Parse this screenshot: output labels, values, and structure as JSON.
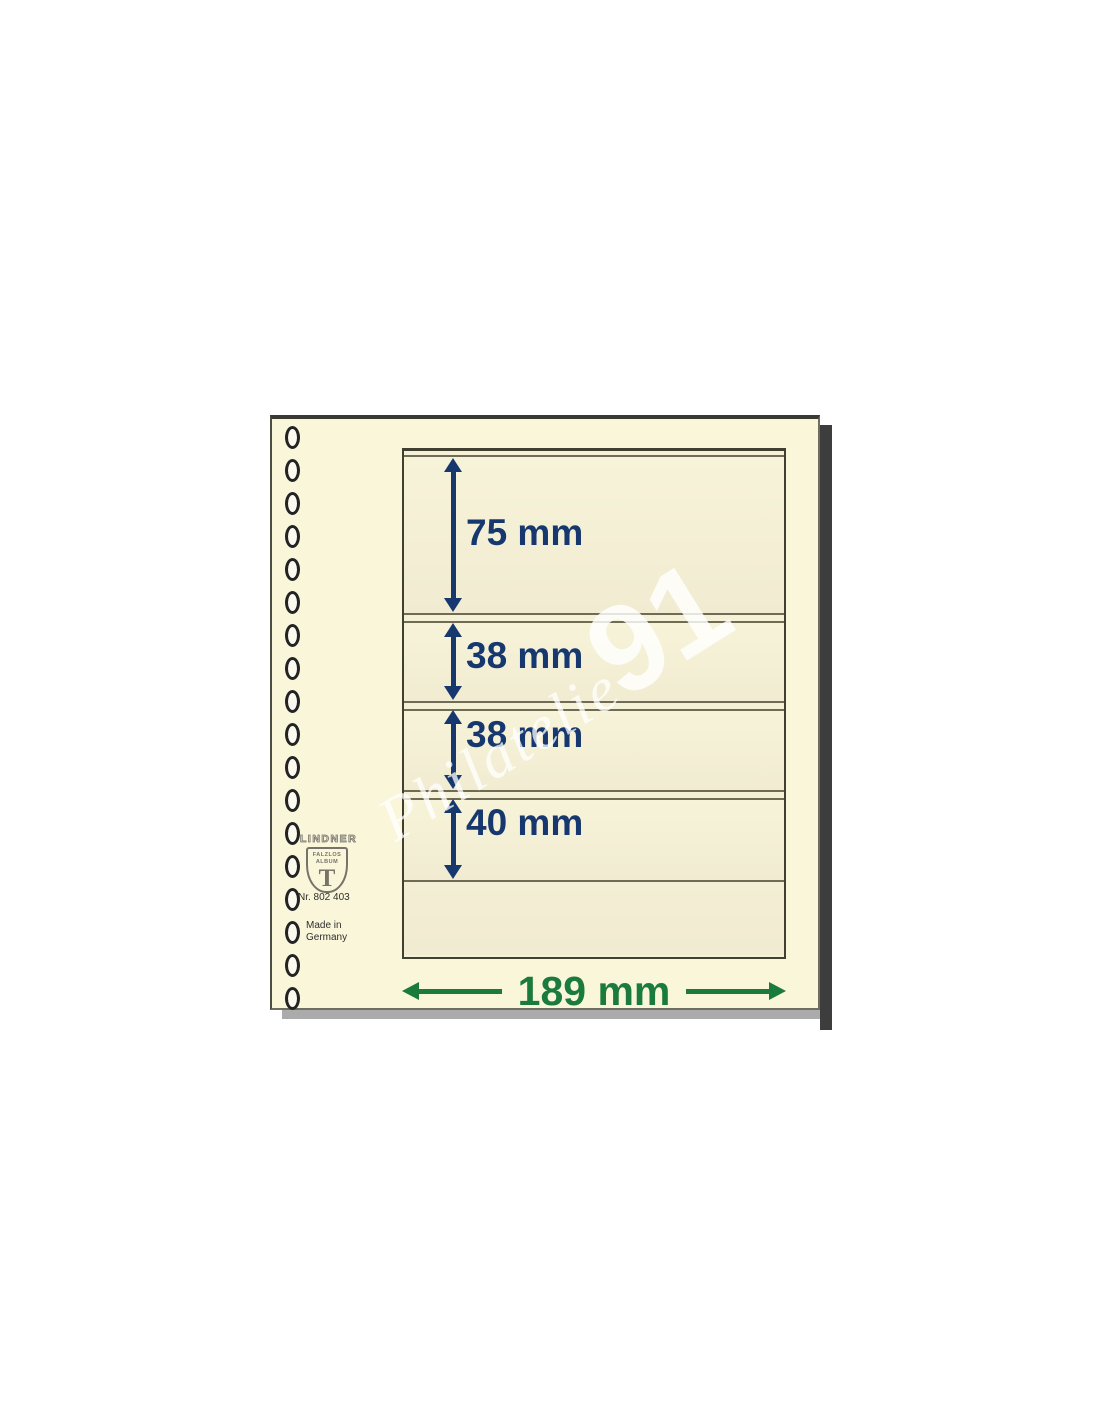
{
  "page": {
    "holes": {
      "count": 18
    },
    "brand": {
      "name": "LINDNER",
      "shield_top": "FALZLOS",
      "shield_mid": "ALBUM",
      "shield_letter": "T"
    },
    "part_number": "Nr. 802 403",
    "made_in": {
      "line1": "Made in",
      "line2": "Germany"
    },
    "pockets": [
      {
        "label": "75 mm"
      },
      {
        "label": "38 mm"
      },
      {
        "label": "38 mm"
      },
      {
        "label": "40 mm"
      }
    ],
    "width_label": "189 mm",
    "watermark": {
      "script": "Philatelie",
      "number": "91"
    },
    "colors": {
      "dimension_blue": "#17386f",
      "dimension_green": "#1b7a3d",
      "paper": "#f9f6da",
      "pocket_line": "#6f6b54"
    }
  }
}
